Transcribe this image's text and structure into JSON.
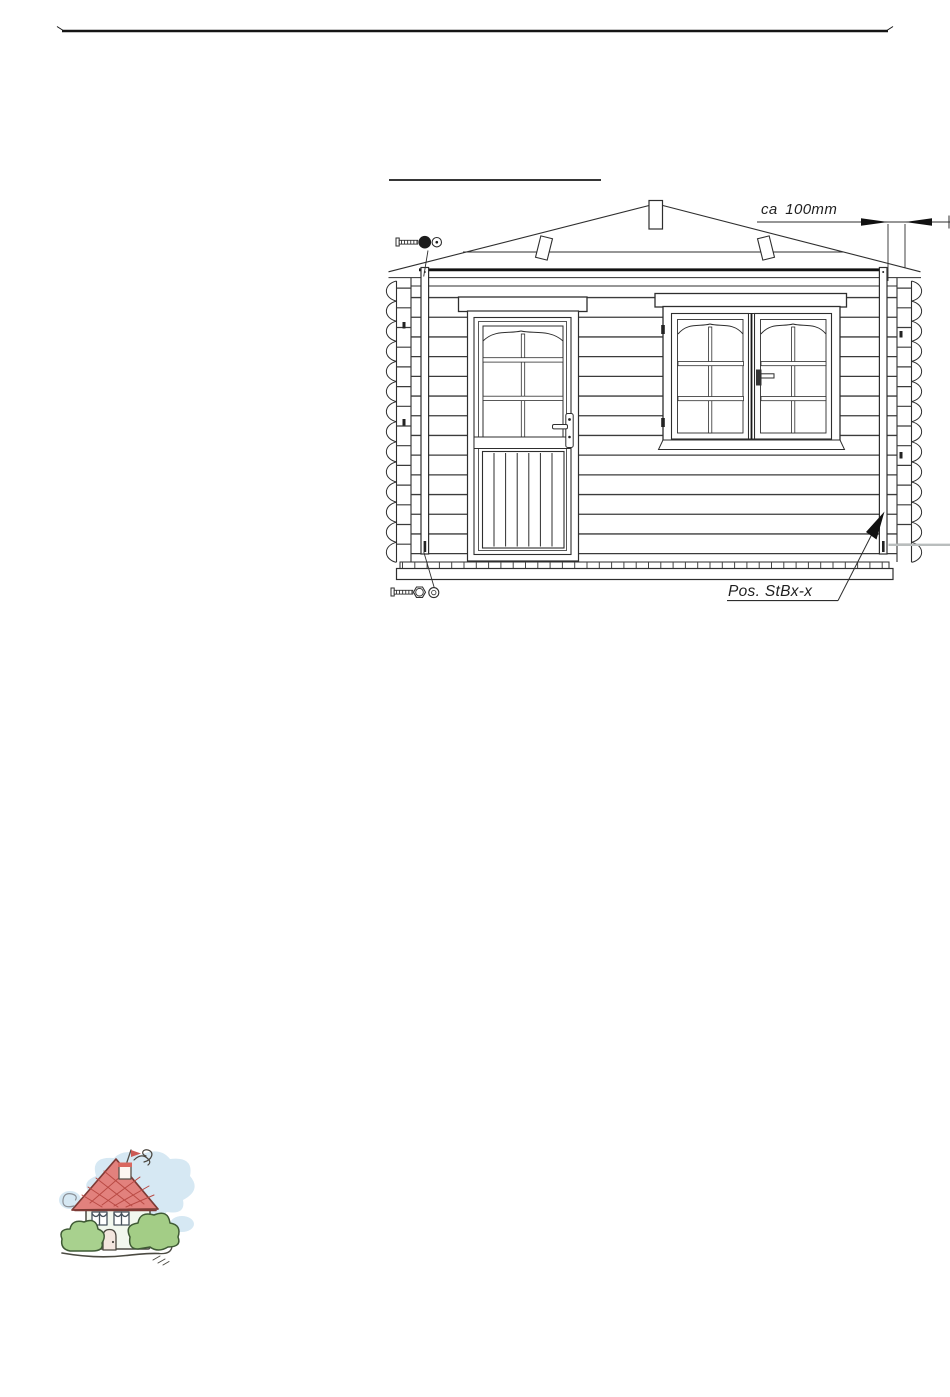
{
  "document": {
    "type": "assembly-manual-page",
    "header_rule": true,
    "labels": {
      "dimension": "ca 100mm",
      "position": "Pos. StBx-x"
    },
    "drawing": {
      "subject": "log-cabin-front-elevation",
      "elements": [
        "roof",
        "apex-block",
        "hip-boards",
        "fascia-board",
        "wall-logs",
        "corner-log-ends-left",
        "corner-log-ends-right",
        "storm-batten-left",
        "storm-batten-right",
        "entrance-door",
        "double-window",
        "floor-base",
        "screw-icon-top",
        "screw-icon-bottom",
        "dimension-arrows",
        "leader-arrow"
      ],
      "colors": {
        "line": "#2e2e2e",
        "bold_line": "#111111",
        "light_gray": "#b9bdbd"
      }
    },
    "clipart": {
      "name": "cartoon-house",
      "colors": {
        "roof": "#e2817d",
        "roof_hatch": "#b94a44",
        "wall": "#f2f7ee",
        "bush": "#a8d18e",
        "sky": "#cfe4f1",
        "door": "#f3e6de",
        "outline": "#4b4a42",
        "flag": "#cc5a55"
      }
    }
  }
}
